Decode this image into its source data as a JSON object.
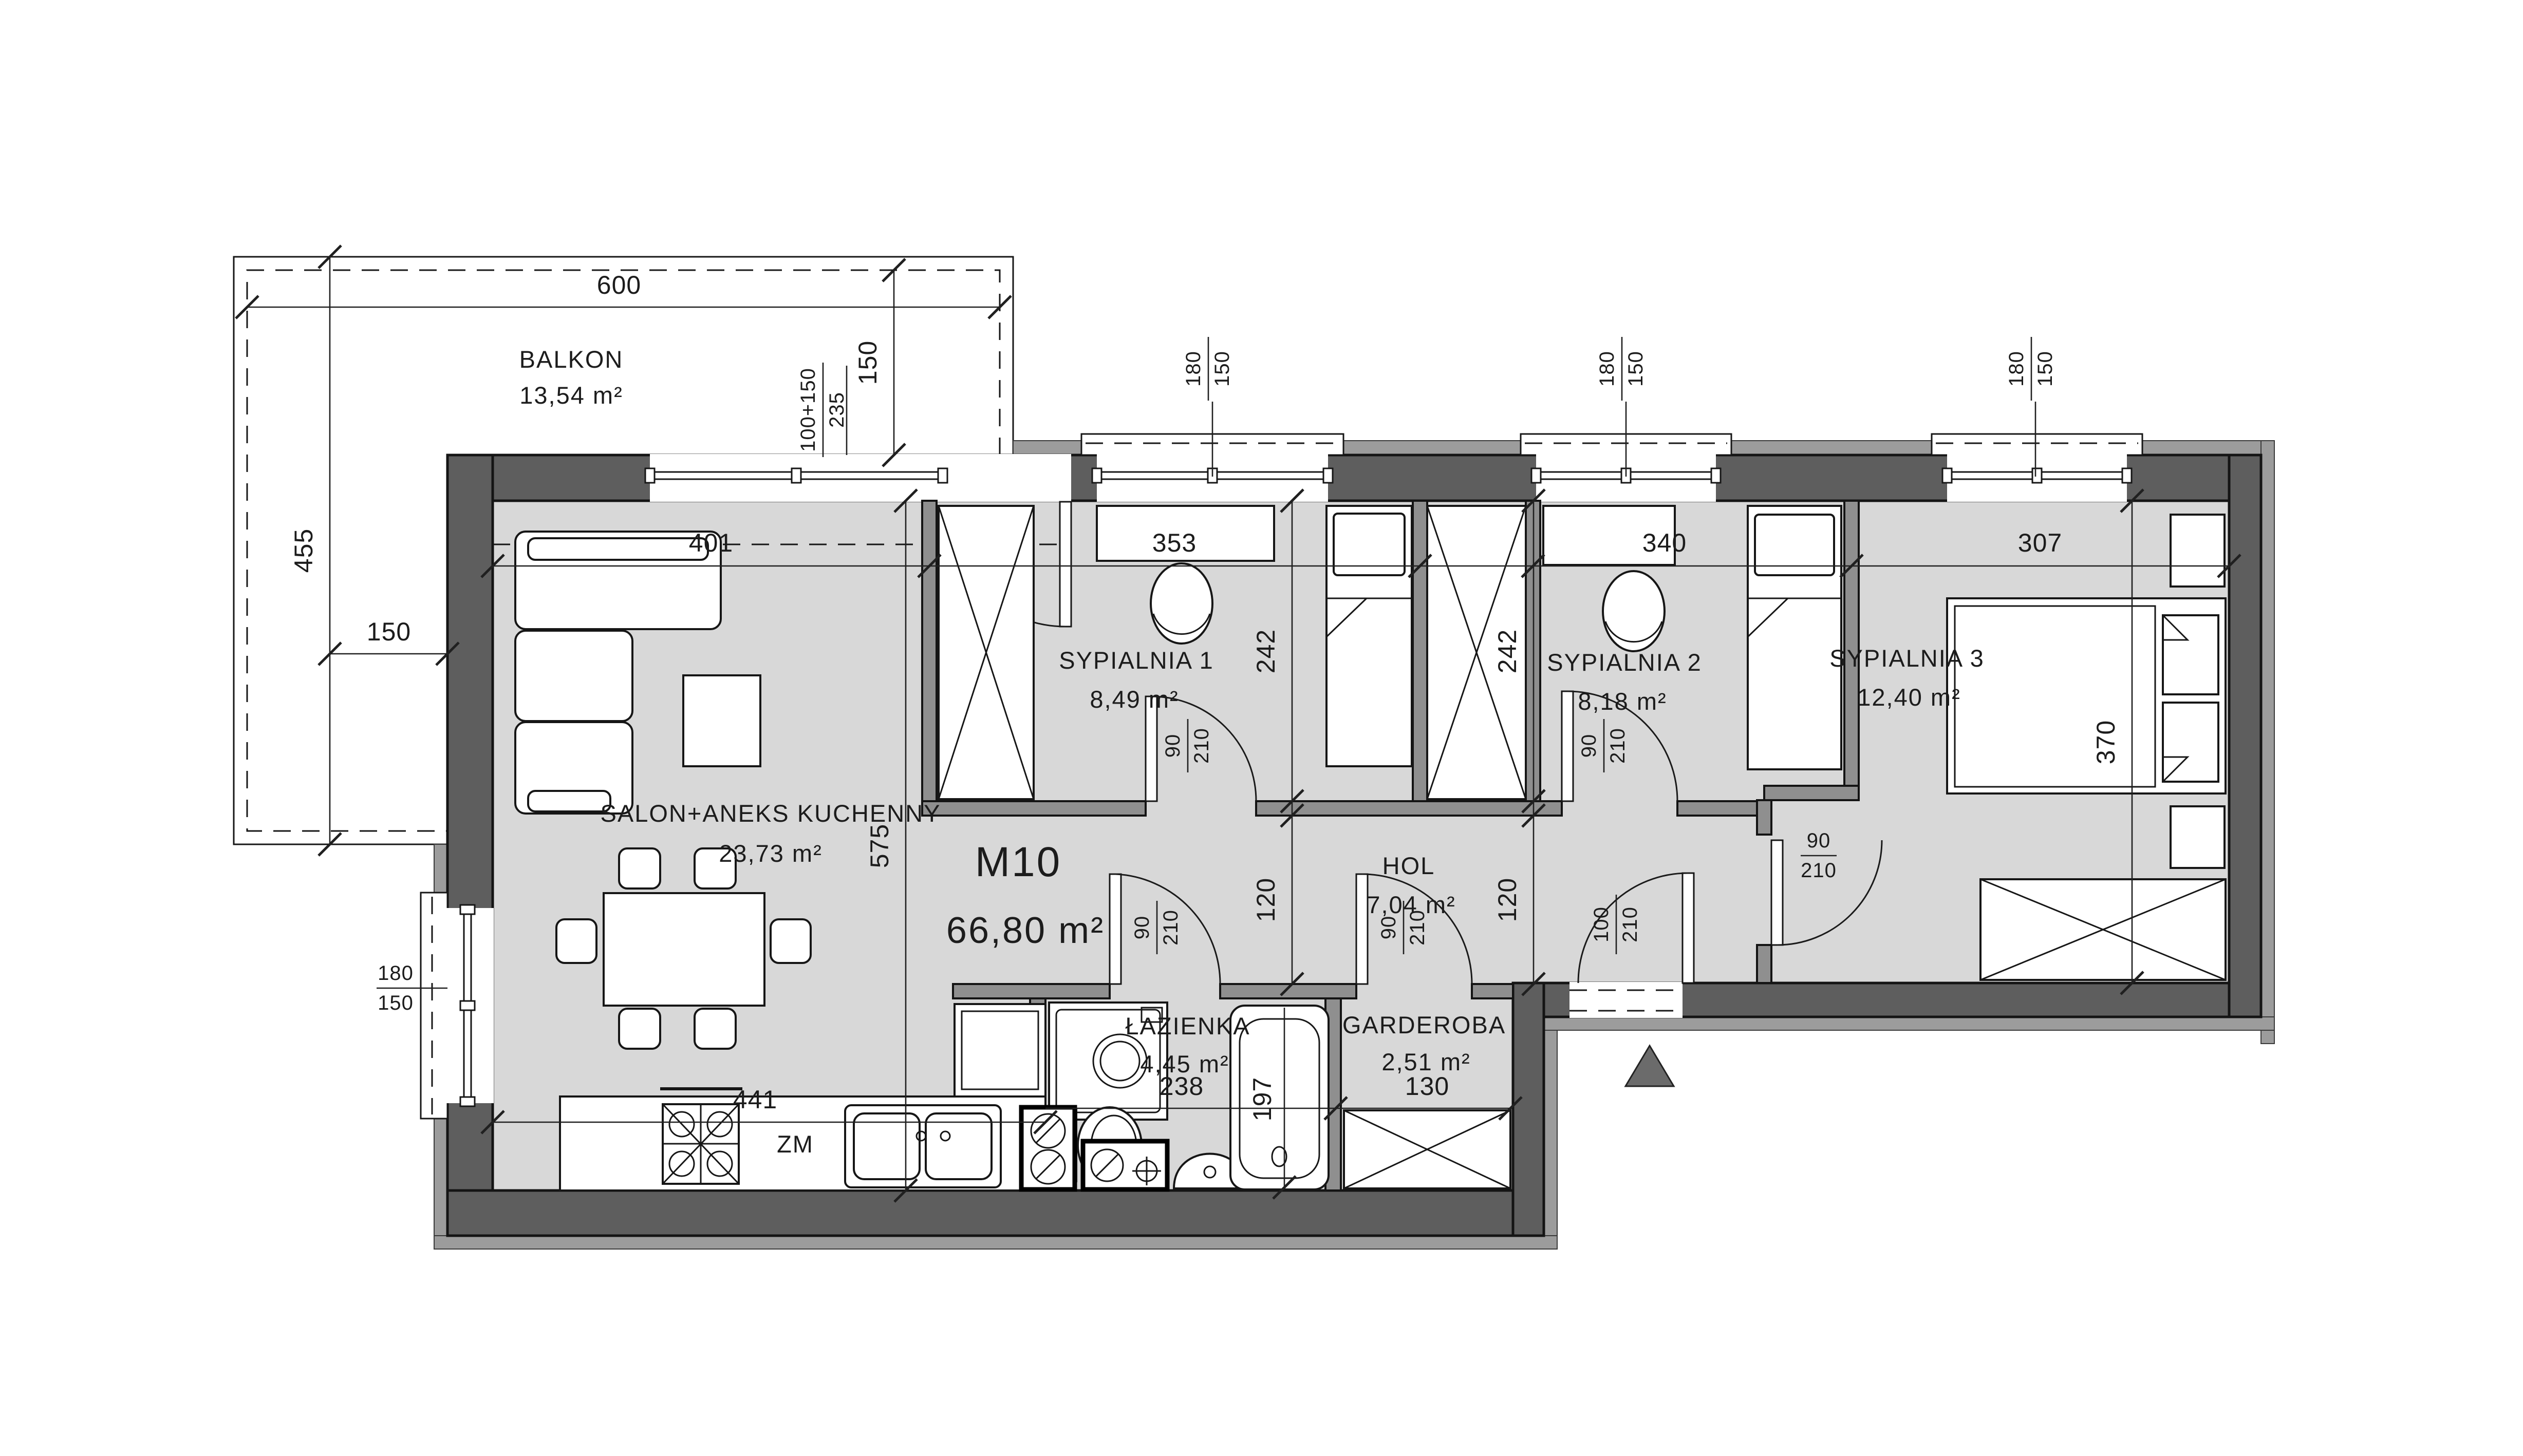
{
  "unit": {
    "code": "M10",
    "area": "66,80 m²"
  },
  "rooms": {
    "balkon": {
      "name": "BALKON",
      "area": "13,54 m²"
    },
    "salon": {
      "name": "SALON+ANEKS KUCHENNY",
      "area": "23,73 m²"
    },
    "sypialnia1": {
      "name": "SYPIALNIA 1",
      "area": "8,49 m²"
    },
    "sypialnia2": {
      "name": "SYPIALNIA 2",
      "area": "8,18 m²"
    },
    "sypialnia3": {
      "name": "SYPIALNIA 3",
      "area": "12,40 m²"
    },
    "hol": {
      "name": "HOL",
      "area": "7,04 m²"
    },
    "lazienka": {
      "name": "ŁAZIENKA",
      "area": "4,45 m²"
    },
    "garderoba": {
      "name": "GARDEROBA",
      "area": "2,51 m²"
    }
  },
  "dims": {
    "balcony_width": "600",
    "balcony_depth": "150",
    "balcony_side_height": "455",
    "balcony_side_width": "150",
    "salon_width": "401",
    "salon_depth": "575",
    "s1_width": "353",
    "s1_depth": "242",
    "s2_width": "340",
    "s2_depth": "242",
    "s3_width": "307",
    "s3_depth": "370",
    "hol_depth_left": "120",
    "hol_depth_right": "120",
    "kitchen_width": "441",
    "bath_width": "238",
    "tub_length": "197",
    "garderoba_width": "130"
  },
  "openings": {
    "balcony_door": {
      "width": "100+150",
      "height": "235"
    },
    "window_s1": {
      "width": "180",
      "height": "150"
    },
    "window_s2": {
      "width": "180",
      "height": "150"
    },
    "window_s3": {
      "width": "180",
      "height": "150"
    },
    "window_salon": {
      "width": "180",
      "height": "150"
    },
    "door_s1": {
      "width": "90",
      "height": "210"
    },
    "door_s2": {
      "width": "90",
      "height": "210"
    },
    "door_s3": {
      "width": "90",
      "height": "210"
    },
    "door_bath": {
      "width": "90",
      "height": "210"
    },
    "door_garderoba": {
      "width": "90",
      "height": "210"
    },
    "door_entry": {
      "width": "100",
      "height": "210"
    }
  },
  "labels": {
    "dishwasher": "ZM"
  },
  "colors": {
    "floor": "#d8d8d8",
    "wall_exterior": "#5e5e5e",
    "wall_interior": "#8f8f8f",
    "facade_band": "#9c9c9c",
    "line": "#1c1c1c",
    "north_arrow": "#6b6b6b"
  }
}
